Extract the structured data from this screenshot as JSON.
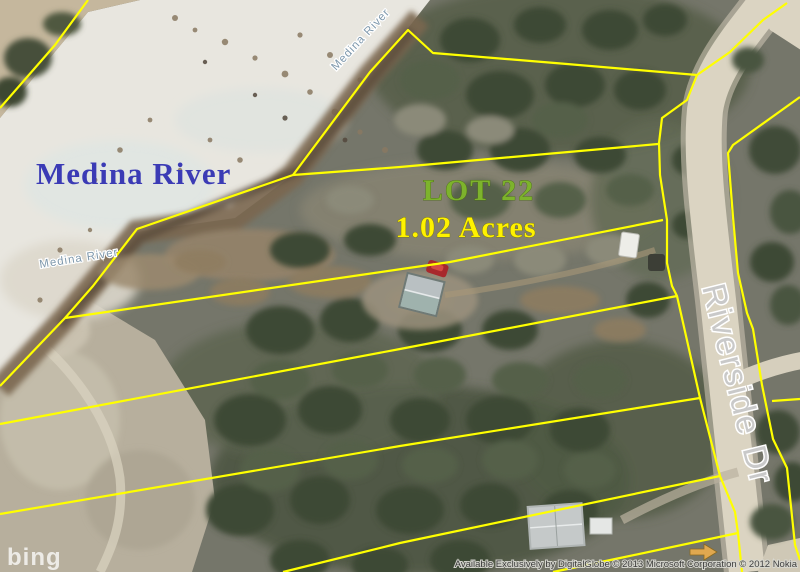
{
  "map": {
    "river_label": "Medina River",
    "river_label_small_top": "Medina River",
    "river_label_small_left": "Medina River",
    "lot_label": "LOT 22",
    "acres_label": "1.02 Acres",
    "street_label": "Riverside Dr",
    "watermark": "bing",
    "attribution": "Available Exclusively by DigitalGlobe © 2013 Microsoft Corporation © 2012 Nokia",
    "colors": {
      "parcel_line": "#ffff00",
      "river_label": "#3b3bb5",
      "small_river_label": "#7e98ac",
      "lot_label": "#7db32c",
      "acres_label": "#fff200",
      "street_label": "#c9c9c9",
      "watermark": "#ffffff",
      "attribution": "#3a3a3a"
    }
  }
}
